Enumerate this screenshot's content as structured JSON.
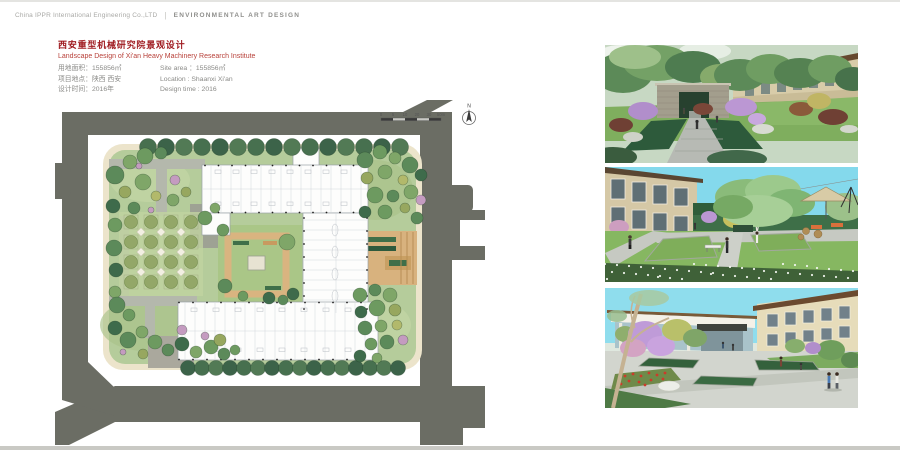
{
  "header": {
    "company": "China IPPR International Engineering Co.,LTD",
    "divider": "|",
    "department": "ENVIRONMENTAL ART DESIGN"
  },
  "title_block": {
    "title_cn": "西安重型机械研究院景观设计",
    "title_en": "Landscape Design of Xi'an Heavy Machinery Research Institute",
    "fields": [
      {
        "cn": "用地面积：155856㎡",
        "en": "Site area ：155856㎡"
      },
      {
        "cn": "项目地点：陕西 西安",
        "en": "Location : Shaanxi Xi'an"
      },
      {
        "cn": "设计时间：2016年",
        "en": "Design time : 2016"
      }
    ]
  },
  "plan": {
    "scale_bar_labels": [
      "0",
      "5",
      "10",
      "20",
      "30",
      "50m"
    ],
    "north_label": "N"
  },
  "colors": {
    "title_red": "#a01d22",
    "road_gray": "#6b6d64",
    "lawn_green": "#b5cc9b",
    "sidewalk_cream": "#ece4cb",
    "sky_cyan": "#87dcee",
    "courtyard_tan": "#d8b27e"
  }
}
